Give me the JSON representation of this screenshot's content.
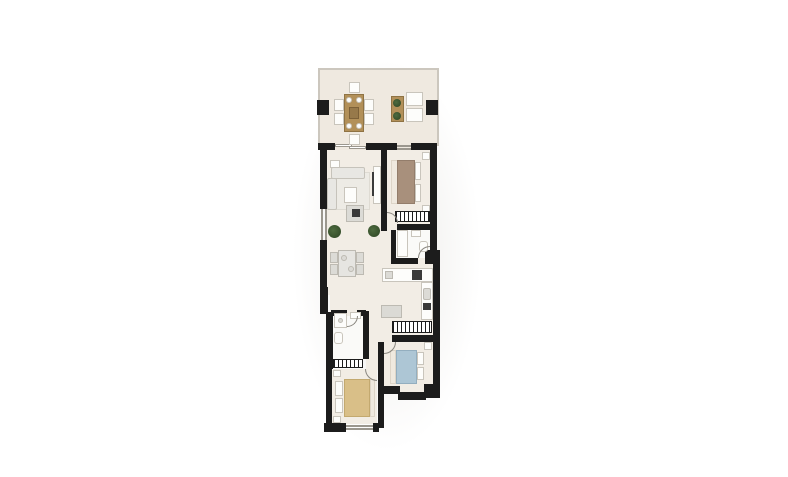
{
  "palette": {
    "background": "#ffffff",
    "wall": "#1c1c1c",
    "room_floor": "#f2ede5",
    "terrace_floor": "#efe9e0",
    "bathroom_floor": "#fafaf8",
    "exterior_outline": "#ccc7be",
    "wood_furniture": "#b29059",
    "white_furniture": "#fdfdfb",
    "gray_furniture": "#dcdbd6",
    "sofa": "#e8e7e3",
    "bed1_taupe": "#a8907c",
    "bed2_blue": "#adc6d5",
    "bed3_tan": "#d9bf88",
    "plant_green": "#3c5531",
    "door_arc": "#8a8780"
  },
  "canvas": {
    "width": 788,
    "height": 477
  },
  "plan": {
    "elements": [
      {
        "n": "plan-shadow",
        "k": "shadow",
        "r": [
          292,
          58,
          190,
          395
        ]
      },
      {
        "n": "terrace-floor",
        "k": "floorT",
        "r": [
          320,
          70,
          117,
          80
        ]
      },
      {
        "n": "living-room-floor",
        "k": "floor",
        "r": [
          327,
          150,
          54,
          145
        ]
      },
      {
        "n": "bedroom1-floor",
        "k": "floor",
        "r": [
          387,
          150,
          43,
          74
        ]
      },
      {
        "n": "kitchen-hall-floor",
        "k": "floor",
        "r": [
          366,
          224,
          67,
          98
        ]
      },
      {
        "n": "hall-floor",
        "k": "floor",
        "r": [
          366,
          322,
          26,
          48
        ]
      },
      {
        "n": "corridor-floor",
        "k": "floor",
        "r": [
          384,
          322,
          49,
          20
        ]
      },
      {
        "n": "passage-floor",
        "k": "floor",
        "r": [
          330,
          295,
          52,
          27
        ]
      },
      {
        "n": "bedroom2-floor",
        "k": "floor",
        "r": [
          384,
          342,
          49,
          50
        ]
      },
      {
        "n": "bedroom3-floor",
        "k": "floor",
        "r": [
          332,
          369,
          45,
          55
        ]
      },
      {
        "n": "bathroom1-floor",
        "k": "floorB",
        "r": [
          396,
          230,
          34,
          28
        ]
      },
      {
        "n": "bathroom2-floor",
        "k": "floorB",
        "r": [
          333,
          316,
          31,
          43
        ]
      },
      {
        "n": "terrace-outline-top",
        "k": "outline",
        "r": [
          318,
          68,
          121,
          2
        ]
      },
      {
        "n": "terrace-outline-left",
        "k": "outline",
        "r": [
          318,
          68,
          2,
          78
        ]
      },
      {
        "n": "terrace-outline-right",
        "k": "outline",
        "r": [
          437,
          68,
          2,
          78
        ]
      },
      {
        "n": "terrace-pillar-left",
        "k": "wall",
        "r": [
          317,
          100,
          12,
          15
        ]
      },
      {
        "n": "terrace-pillar-right",
        "k": "wall",
        "r": [
          426,
          100,
          12,
          15
        ]
      },
      {
        "n": "wall-top-a",
        "k": "wall",
        "r": [
          318,
          143,
          17,
          7
        ]
      },
      {
        "n": "wall-top-b",
        "k": "wall",
        "r": [
          366,
          143,
          31,
          7
        ]
      },
      {
        "n": "wall-top-c",
        "k": "wall",
        "r": [
          411,
          143,
          26,
          7
        ]
      },
      {
        "n": "terrace-slider-glass-a",
        "k": "glass",
        "r": [
          335,
          144,
          17,
          3
        ]
      },
      {
        "n": "terrace-slider-glass-b",
        "k": "glass",
        "r": [
          349,
          146,
          17,
          3
        ]
      },
      {
        "n": "bedroom1-window-a",
        "k": "glass",
        "r": [
          397,
          145,
          14,
          2
        ]
      },
      {
        "n": "bedroom1-window-b",
        "k": "glass",
        "r": [
          397,
          148,
          14,
          2
        ]
      },
      {
        "n": "wall-left-upper",
        "k": "wall",
        "r": [
          320,
          143,
          7,
          66
        ]
      },
      {
        "n": "living-window-a",
        "k": "glass",
        "r": [
          321,
          209,
          2,
          31
        ]
      },
      {
        "n": "living-window-b",
        "k": "glass",
        "r": [
          325,
          209,
          2,
          31
        ]
      },
      {
        "n": "wall-left-mid",
        "k": "wall",
        "r": [
          320,
          240,
          7,
          49
        ]
      },
      {
        "n": "wall-left-jog",
        "k": "wall",
        "r": [
          320,
          287,
          8,
          27
        ]
      },
      {
        "n": "wall-right-upper",
        "k": "wall",
        "r": [
          430,
          143,
          7,
          110
        ]
      },
      {
        "n": "wall-entry-jog",
        "k": "wall",
        "r": [
          425,
          250,
          15,
          14
        ]
      },
      {
        "n": "wall-kitchen-right",
        "k": "wall",
        "r": [
          433,
          262,
          7,
          62
        ]
      },
      {
        "n": "wall-bedroom2-right",
        "k": "wall",
        "r": [
          433,
          322,
          7,
          76
        ]
      },
      {
        "n": "wall-partition-living",
        "k": "wall",
        "r": [
          381,
          143,
          6,
          88
        ]
      },
      {
        "n": "wall-bedroom1-bottom",
        "k": "wall",
        "r": [
          397,
          224,
          35,
          6
        ]
      },
      {
        "n": "wall-bathroom1-left",
        "k": "wall",
        "r": [
          391,
          230,
          5,
          34
        ]
      },
      {
        "n": "wall-bathroom1-bottom",
        "k": "wall",
        "r": [
          391,
          258,
          27,
          6
        ]
      },
      {
        "n": "wall-bathroom2-left",
        "k": "wall",
        "r": [
          326,
          312,
          7,
          57
        ]
      },
      {
        "n": "wall-bathroom2-top-a",
        "k": "wall",
        "r": [
          331,
          310,
          16,
          6
        ]
      },
      {
        "n": "wall-bathroom2-top-b",
        "k": "wall",
        "r": [
          357,
          310,
          9,
          6
        ]
      },
      {
        "n": "wall-bathroom2-right",
        "k": "wall",
        "r": [
          363,
          311,
          6,
          48
        ]
      },
      {
        "n": "wall-bedroom3-left",
        "k": "wall",
        "r": [
          326,
          369,
          6,
          59
        ]
      },
      {
        "n": "wall-bedroom3-bottom",
        "k": "wall",
        "r": [
          324,
          423,
          22,
          9
        ]
      },
      {
        "n": "bedroom3-window-a",
        "k": "glass",
        "r": [
          346,
          425,
          27,
          2
        ]
      },
      {
        "n": "bedroom3-window-b",
        "k": "glass",
        "r": [
          346,
          428,
          27,
          2
        ]
      },
      {
        "n": "wall-bedroom3-bottom-b",
        "k": "wall",
        "r": [
          373,
          423,
          6,
          9
        ]
      },
      {
        "n": "wall-divider-bedrooms",
        "k": "wall",
        "r": [
          378,
          342,
          6,
          86
        ]
      },
      {
        "n": "wall-bedroom2-top",
        "k": "wall",
        "r": [
          392,
          335,
          41,
          7
        ]
      },
      {
        "n": "wall-bedroom2-bottom-a",
        "k": "wall",
        "r": [
          384,
          386,
          16,
          8
        ]
      },
      {
        "n": "wall-bedroom2-bottom-b",
        "k": "wall",
        "r": [
          398,
          392,
          28,
          8
        ]
      },
      {
        "n": "wall-bedroom2-corner",
        "k": "wall",
        "r": [
          424,
          384,
          16,
          14
        ]
      },
      {
        "n": "outdoor-dining-table",
        "k": "wood",
        "r": [
          344,
          94,
          20,
          38
        ]
      },
      {
        "n": "outdoor-chair-north",
        "k": "wfurn",
        "r": [
          349,
          82,
          11,
          11
        ]
      },
      {
        "n": "outdoor-chair-south",
        "k": "wfurn",
        "r": [
          349,
          134,
          11,
          11
        ]
      },
      {
        "n": "outdoor-chair-west-1",
        "k": "wfurn",
        "r": [
          334,
          99,
          10,
          12
        ]
      },
      {
        "n": "outdoor-chair-west-2",
        "k": "wfurn",
        "r": [
          334,
          113,
          10,
          12
        ]
      },
      {
        "n": "outdoor-chair-east-1",
        "k": "wfurn",
        "r": [
          364,
          99,
          10,
          12
        ]
      },
      {
        "n": "outdoor-chair-east-2",
        "k": "wfurn",
        "r": [
          364,
          113,
          10,
          12
        ]
      },
      {
        "n": "outdoor-plate-1",
        "k": "wfurn round",
        "r": [
          346,
          97,
          6,
          6
        ]
      },
      {
        "n": "outdoor-plate-2",
        "k": "wfurn round",
        "r": [
          356,
          97,
          6,
          6
        ]
      },
      {
        "n": "outdoor-plate-3",
        "k": "wfurn round",
        "r": [
          346,
          123,
          6,
          6
        ]
      },
      {
        "n": "outdoor-plate-4",
        "k": "wfurn round",
        "r": [
          356,
          123,
          6,
          6
        ]
      },
      {
        "n": "outdoor-table-runner",
        "k": "woodD",
        "r": [
          349,
          107,
          10,
          12
        ]
      },
      {
        "n": "terrace-console",
        "k": "wood",
        "r": [
          391,
          96,
          13,
          26
        ]
      },
      {
        "n": "console-plant-1",
        "k": "plant",
        "r": [
          393,
          99,
          8,
          8
        ]
      },
      {
        "n": "console-plant-2",
        "k": "plant",
        "r": [
          393,
          112,
          8,
          8
        ]
      },
      {
        "n": "lounge-chair-1",
        "k": "wfurn",
        "r": [
          406,
          92,
          17,
          14
        ]
      },
      {
        "n": "lounge-chair-2",
        "k": "wfurn",
        "r": [
          406,
          108,
          17,
          14
        ]
      },
      {
        "n": "living-side-table",
        "k": "wfurn",
        "r": [
          330,
          160,
          10,
          8
        ]
      },
      {
        "n": "living-rug",
        "k": "rug",
        "r": [
          333,
          172,
          37,
          38
        ]
      },
      {
        "n": "sofa-top-section",
        "k": "sofa",
        "r": [
          331,
          167,
          34,
          12
        ]
      },
      {
        "n": "sofa-left-section",
        "k": "sofa",
        "r": [
          327,
          178,
          10,
          32
        ]
      },
      {
        "n": "coffee-table",
        "k": "wfurn",
        "r": [
          344,
          187,
          13,
          16
        ]
      },
      {
        "n": "tv-unit",
        "k": "wfurn",
        "r": [
          373,
          166,
          8,
          38
        ]
      },
      {
        "n": "tv-screen",
        "k": "dark",
        "r": [
          372,
          172,
          2,
          24
        ]
      },
      {
        "n": "media-table",
        "k": "gfurn",
        "r": [
          346,
          205,
          18,
          17
        ]
      },
      {
        "n": "media-table-inner",
        "k": "dark",
        "r": [
          352,
          209,
          8,
          8
        ]
      },
      {
        "n": "living-plant-1",
        "k": "plant",
        "r": [
          328,
          225,
          13,
          13
        ]
      },
      {
        "n": "living-plant-2",
        "k": "plant",
        "r": [
          368,
          225,
          12,
          12
        ]
      },
      {
        "n": "dining-table",
        "k": "gfurn",
        "r": [
          338,
          250,
          18,
          27
        ],
        "f": "#e6e5e1"
      },
      {
        "n": "dining-chair-1",
        "k": "gfurn",
        "r": [
          330,
          252,
          8,
          11
        ]
      },
      {
        "n": "dining-chair-2",
        "k": "gfurn",
        "r": [
          330,
          264,
          8,
          11
        ]
      },
      {
        "n": "dining-chair-3",
        "k": "gfurn",
        "r": [
          356,
          252,
          8,
          11
        ]
      },
      {
        "n": "dining-chair-4",
        "k": "gfurn",
        "r": [
          356,
          264,
          8,
          11
        ]
      },
      {
        "n": "dining-plate-1",
        "k": "gfurn round",
        "r": [
          341,
          255,
          6,
          6
        ]
      },
      {
        "n": "dining-plate-2",
        "k": "gfurn round",
        "r": [
          348,
          266,
          6,
          6
        ]
      },
      {
        "n": "bedroom1-bed-sheet",
        "k": "sheet",
        "r": [
          391,
          160,
          7,
          44
        ]
      },
      {
        "n": "bedroom1-bed-blanket",
        "k": "taupe",
        "r": [
          397,
          160,
          18,
          44
        ]
      },
      {
        "n": "bedroom1-pillow-1",
        "k": "wfurn",
        "r": [
          415,
          162,
          6,
          18
        ]
      },
      {
        "n": "bedroom1-pillow-2",
        "k": "wfurn",
        "r": [
          415,
          184,
          6,
          18
        ]
      },
      {
        "n": "bedroom1-nightstand-1",
        "k": "wfurn",
        "r": [
          422,
          152,
          8,
          8
        ]
      },
      {
        "n": "bedroom1-nightstand-2",
        "k": "wfurn",
        "r": [
          422,
          205,
          8,
          8
        ]
      },
      {
        "n": "bedroom1-wardrobe",
        "k": "hatch",
        "r": [
          395,
          211,
          35,
          11
        ]
      },
      {
        "n": "bedroom1-door-arc",
        "k": "arc arc-tr",
        "r": [
          387,
          212,
          11,
          11
        ]
      },
      {
        "n": "bathtub",
        "k": "wfurn",
        "r": [
          397,
          230,
          11,
          27
        ]
      },
      {
        "n": "bathroom1-basin",
        "k": "wfurn",
        "r": [
          411,
          230,
          10,
          7
        ]
      },
      {
        "n": "bathroom1-toilet",
        "k": "wfurn",
        "r": [
          419,
          241,
          9,
          11
        ],
        "rad": "3px"
      },
      {
        "n": "bathroom1-door-arc",
        "k": "arc arc-tl",
        "r": [
          418,
          246,
          12,
          12
        ]
      },
      {
        "n": "kitchen-counter-top",
        "k": "wfurn",
        "r": [
          382,
          268,
          51,
          14
        ]
      },
      {
        "n": "kitchen-counter-right",
        "k": "wfurn",
        "r": [
          421,
          282,
          12,
          38
        ]
      },
      {
        "n": "kitchen-sink",
        "k": "gfurn",
        "r": [
          423,
          288,
          8,
          12
        ],
        "rad": "2px"
      },
      {
        "n": "kitchen-hob",
        "k": "dark",
        "r": [
          423,
          303,
          8,
          7
        ]
      },
      {
        "n": "kitchen-oven",
        "k": "dark",
        "r": [
          412,
          270,
          10,
          10
        ]
      },
      {
        "n": "kitchen-counter-item",
        "k": "gfurn",
        "r": [
          385,
          271,
          8,
          8
        ]
      },
      {
        "n": "kitchen-mat",
        "k": "gfurn",
        "r": [
          381,
          305,
          21,
          13
        ],
        "f": "#dbdad5"
      },
      {
        "n": "hall-wardrobe",
        "k": "hatch",
        "r": [
          392,
          321,
          40,
          12
        ]
      },
      {
        "n": "bedroom3-wardrobe",
        "k": "hatch",
        "r": [
          333,
          359,
          30,
          9
        ]
      },
      {
        "n": "bedroom2-bed-sheet",
        "k": "sheet",
        "r": [
          390,
          350,
          6,
          34
        ]
      },
      {
        "n": "bedroom2-bed-blanket",
        "k": "blue",
        "r": [
          396,
          350,
          21,
          34
        ]
      },
      {
        "n": "bedroom2-pillow-1",
        "k": "wfurn",
        "r": [
          417,
          352,
          7,
          13
        ]
      },
      {
        "n": "bedroom2-pillow-2",
        "k": "wfurn",
        "r": [
          417,
          367,
          7,
          13
        ]
      },
      {
        "n": "bedroom2-nightstand",
        "k": "wfurn",
        "r": [
          424,
          342,
          8,
          8
        ]
      },
      {
        "n": "bedroom2-door-arc",
        "k": "arc arc-br",
        "r": [
          384,
          342,
          12,
          12
        ]
      },
      {
        "n": "bedroom3-nightstand-1",
        "k": "wfurn",
        "r": [
          333,
          370,
          8,
          7
        ]
      },
      {
        "n": "bedroom3-nightstand-2",
        "k": "wfurn",
        "r": [
          333,
          416,
          8,
          7
        ]
      },
      {
        "n": "bedroom3-pillow-1",
        "k": "wfurn",
        "r": [
          335,
          381,
          8,
          15
        ]
      },
      {
        "n": "bedroom3-pillow-2",
        "k": "wfurn",
        "r": [
          335,
          398,
          8,
          15
        ]
      },
      {
        "n": "bedroom3-bed-blanket",
        "k": "tan",
        "r": [
          344,
          379,
          26,
          38
        ]
      },
      {
        "n": "bedroom3-bed-sheet",
        "k": "sheet",
        "r": [
          370,
          379,
          5,
          38
        ]
      },
      {
        "n": "bedroom3-door-arc",
        "k": "arc arc-bl",
        "r": [
          365,
          369,
          12,
          12
        ]
      },
      {
        "n": "shower-tray",
        "k": "wfurn",
        "r": [
          334,
          313,
          13,
          15
        ]
      },
      {
        "n": "shower-drain",
        "k": "gfurn round",
        "r": [
          338,
          318,
          5,
          5
        ]
      },
      {
        "n": "bathroom2-toilet",
        "k": "wfurn",
        "r": [
          334,
          332,
          9,
          12
        ],
        "rad": "3px"
      },
      {
        "n": "bathroom2-basin",
        "k": "wfurn",
        "r": [
          350,
          312,
          11,
          7
        ]
      },
      {
        "n": "bathroom2-door-arc",
        "k": "arc arc-br",
        "r": [
          347,
          316,
          11,
          11
        ]
      }
    ]
  }
}
